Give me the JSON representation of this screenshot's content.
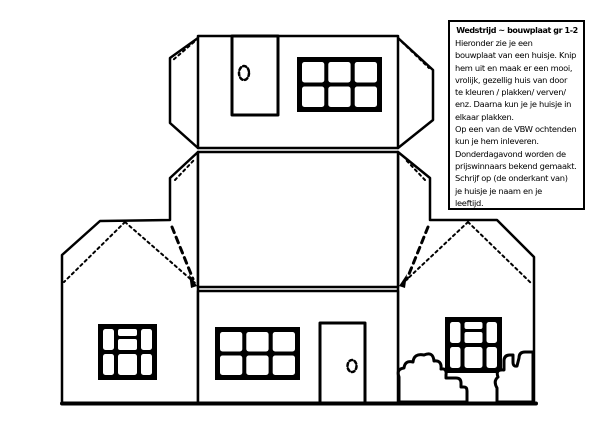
{
  "colors": {
    "ink": "#000000",
    "paper": "#ffffff"
  },
  "instructions": {
    "title": "Wedstrijd ~ bouwplaat gr 1-2",
    "lines": [
      "Hieronder zie je een",
      "bouwplaat van een huisje. Knip",
      "hem uit en maak er een mooi,",
      "vrolijk, gezellig huis van door",
      "te kleuren / plakken/ verven/",
      "enz. Daarna kun je je huisje in",
      "elkaar plakken.",
      "Op een van de VBW ochtenden",
      "kun je hem inleveren.",
      "Donderdagavond worden de",
      "prijswinnaars bekend gemaakt.",
      "Schrijf op (de onderkant van)",
      "je huisje je naam en je",
      "leeftijd."
    ]
  }
}
